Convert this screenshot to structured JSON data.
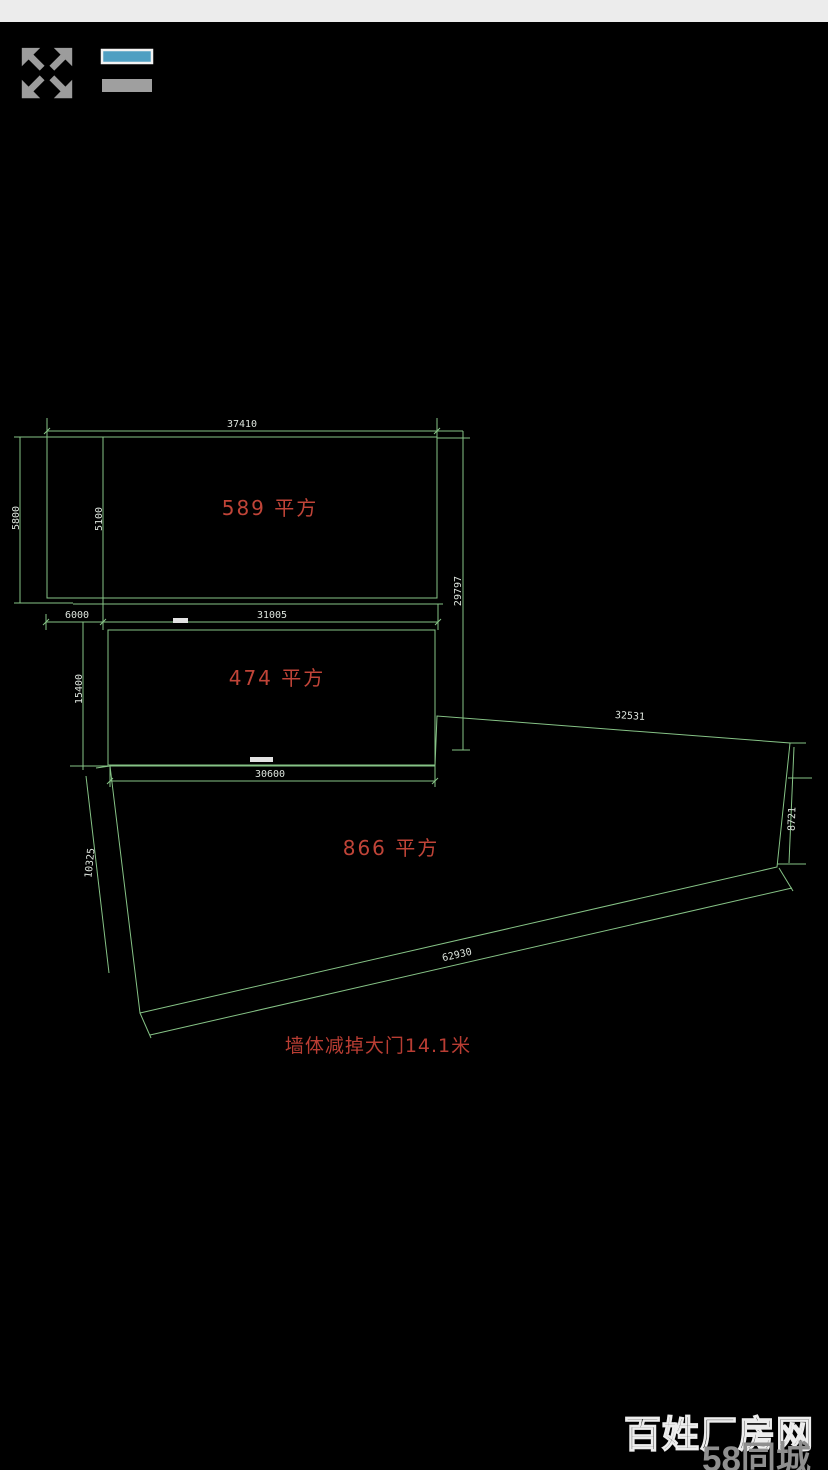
{
  "app": {
    "background": "#000000"
  },
  "status_bar": {
    "color": "#ececec"
  },
  "toolbar": {
    "fullscreen_button": {
      "icon": "fullscreen-arrows-icon"
    },
    "layers_button": {
      "icon": "layers-icon",
      "accent_color": "#4f9fc2"
    }
  },
  "drawing": {
    "palette": {
      "lines": "#86c386",
      "dim_text": "#dce3dc",
      "labels": "#c04438"
    },
    "labels": {
      "room1": "589 平方",
      "room2": "474 平方",
      "room3": "866 平方",
      "note": "墙体减掉大门14.1米"
    },
    "dims": {
      "top_width": "37410",
      "left_height": "5800",
      "inner_left_height": "5100",
      "right_height": "29797",
      "gap_width": "6000",
      "mid_top_width": "31005",
      "mid_left_height": "15400",
      "mid_bottom_width": "30600",
      "top_diagonal": "32531",
      "right_side": "8721",
      "left_slant": "10325",
      "bottom_diagonal": "62930"
    }
  },
  "watermark": {
    "site": "百姓厂房网",
    "brand": "58同城"
  }
}
